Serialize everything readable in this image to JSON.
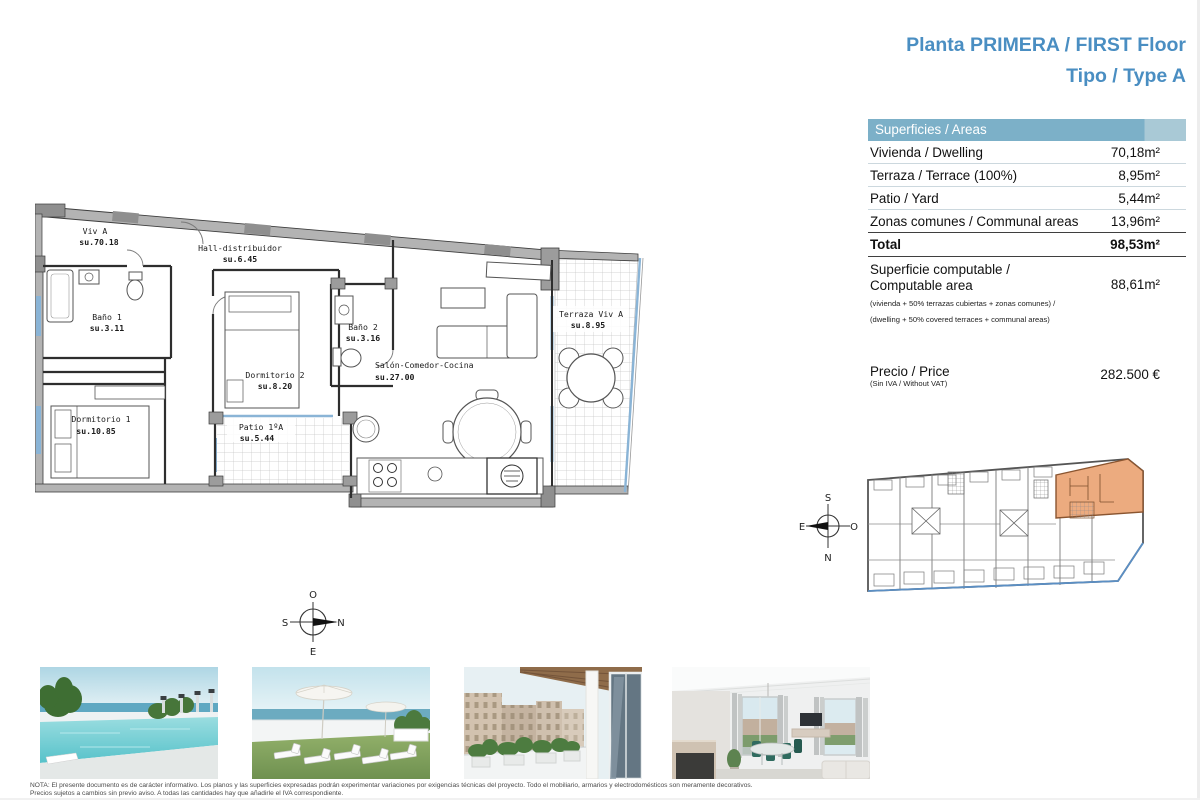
{
  "header": {
    "title_line1": "Planta PRIMERA / FIRST Floor",
    "title_line2": "Tipo / Type A"
  },
  "areas_table": {
    "header": "Superficies / Areas",
    "rows": [
      {
        "label": "Vivienda / Dwelling",
        "value": "70,18m²"
      },
      {
        "label": "Terraza / Terrace (100%)",
        "value": "8,95m²"
      },
      {
        "label": "Patio / Yard",
        "value": "5,44m²"
      },
      {
        "label": "Zonas comunes / Communal areas",
        "value": "13,96m²"
      }
    ],
    "total": {
      "label": "Total",
      "value": "98,53m²"
    },
    "computable": {
      "label_line1": "Superficie computable /",
      "label_line2": "Computable area",
      "note_line1": "(vivienda + 50% terrazas cubiertas + zonas comunes) /",
      "note_line2": "(dwelling + 50% covered terraces + communal areas)",
      "value": "88,61m²"
    },
    "price": {
      "label": "Precio / Price",
      "note": "(Sin IVA / Without VAT)",
      "value": "282.500 €"
    }
  },
  "floor_plan": {
    "rooms": [
      {
        "name": "Viv A",
        "area": "su.70.18"
      },
      {
        "name": "Hall-distribuidor",
        "area": "su.6.45"
      },
      {
        "name": "Baño 1",
        "area": "su.3.11"
      },
      {
        "name": "Dormitorio 2",
        "area": "su.8.20"
      },
      {
        "name": "Baño 2",
        "area": "su.3.16"
      },
      {
        "name": "Salón-Comedor-Cocina",
        "area": "su.27.00"
      },
      {
        "name": "Terraza Viv A",
        "area": "su.8.95"
      },
      {
        "name": "Dormitorio 1",
        "area": "su.10.85"
      },
      {
        "name": "Patio 1ºA",
        "area": "su.5.44"
      }
    ],
    "compass_main": {
      "top": "O",
      "left": "S",
      "right": "N",
      "bottom": "E"
    },
    "compass_site": {
      "top": "S",
      "left": "E",
      "right": "O",
      "bottom": "N"
    },
    "colors": {
      "unit_highlight": "#ecab7f",
      "glass_blue": "#8ab4d6",
      "accent_blue": "#4a8ec2"
    }
  },
  "photos": [
    {
      "name": "rooftop pool with sea view"
    },
    {
      "name": "roof terrace with sun loungers"
    },
    {
      "name": "balcony with street view"
    },
    {
      "name": "living-dining room interior"
    }
  ],
  "disclaimer": {
    "line1": "NOTA: El presente documento es de carácter informativo. Los planos y las superficies expresadas podrán experimentar variaciones por exigencias técnicas del proyecto. Todo el mobiliario, armarios y electrodomésticos son meramente decorativos.",
    "line2": "Precios sujetos a cambios sin previo aviso. A todas las cantidades hay que añadirle el IVA correspondiente."
  }
}
